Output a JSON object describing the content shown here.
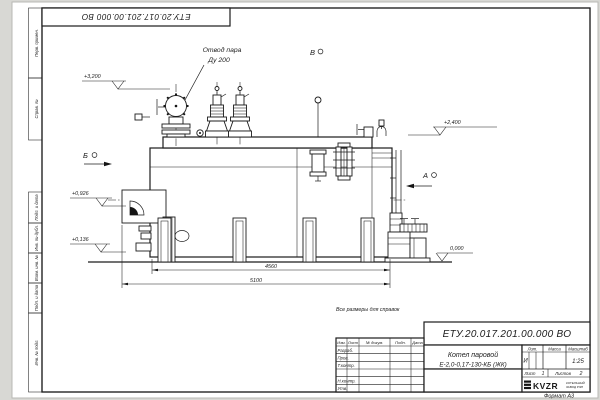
{
  "page": {
    "note": "Все размеры для справок",
    "format_label": "Формат А3"
  },
  "designation": "ЕТУ.20.017.201.00.000 ВО",
  "margin_labels": [
    "Перв. примен.",
    "Справ. №",
    "Подп. и дата",
    "Инв. № дубл.",
    "Взам. инв. №",
    "Подп. и дата",
    "Инв. № подл."
  ],
  "annotations": {
    "steam_outlet_line1": "Отвод пара",
    "steam_outlet_line2": "Ду 200",
    "view_b": "Б",
    "view_v": "В",
    "view_a": "А"
  },
  "elevations": [
    "+3,200",
    "+2,400",
    "+0,926",
    "+0,136",
    "0,000"
  ],
  "dimensions": [
    "4560",
    "5100"
  ],
  "title_block": {
    "name_line1": "Котел паровой",
    "name_line2": "Е-2,0-0,17-130-КБ (ЖК)",
    "col_izm": "Изм.",
    "col_list": "Лист",
    "col_doc": "№ докум.",
    "col_sign": "Подп.",
    "col_date": "Дата",
    "row_razrab": "Разраб.",
    "row_prov": "Пров.",
    "row_tkontr": "Т.контр.",
    "row_nkontr": "Н.контр.",
    "row_utv": "Утв.",
    "lit_header": "Лит.",
    "mass_header": "Масса",
    "scale_header": "Масштаб",
    "lit_value": "И",
    "scale_value": "1:25",
    "sheet_label": "Лист",
    "sheet_number": "1",
    "sheets_label": "Листов",
    "sheets_total": "2",
    "logo_text": "KVZR",
    "logo_sub1": "КОТЕЛЬНЫЙ",
    "logo_sub2": "ЗАВОД РЭП"
  }
}
